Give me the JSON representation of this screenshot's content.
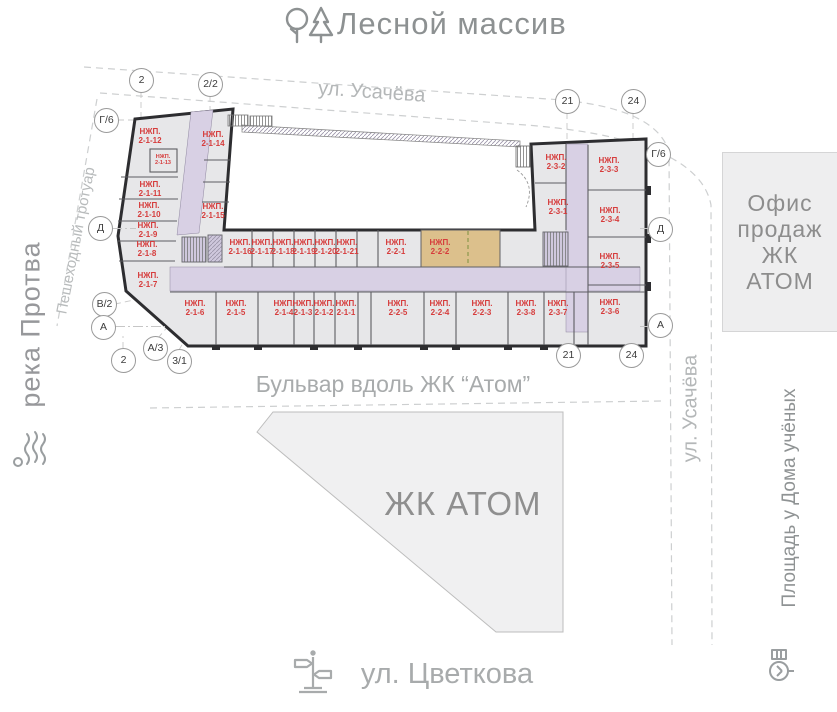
{
  "map": {
    "north_label": "Лесной массив",
    "street_top": "ул. Усачёва",
    "street_right": "ул. Усачёва",
    "street_bottom": "ул. Цветкова",
    "river": "река Протва",
    "sidewalk": "Пешеходный тротуар",
    "boulevard": "Бульвар вдоль ЖК “Атом”",
    "square_right": "Площадь у Дома учёных",
    "complex_area_label": "ЖК АТОМ",
    "sales_office": {
      "lines": [
        "Офис",
        "продаж",
        "ЖК",
        "АТОМ"
      ]
    }
  },
  "building": {
    "unit_prefix": "НЖП.",
    "highlighted_unit": "2-2-2",
    "units": [
      "2-1-12",
      "2-1-13",
      "2-1-14",
      "2-1-11",
      "2-1-10",
      "2-1-9",
      "2-1-8",
      "2-1-7",
      "2-1-15",
      "2-1-16",
      "2-1-17",
      "2-1-18",
      "2-1-19",
      "2-1-20",
      "2-1-21",
      "2-2-1",
      "2-2-2",
      "2-1-6",
      "2-1-5",
      "2-1-4",
      "2-1-3",
      "2-1-2",
      "2-1-1",
      "2-2-5",
      "2-2-4",
      "2-2-3",
      "2-3-8",
      "2-3-7",
      "2-3-2",
      "2-3-3",
      "2-3-1",
      "2-3-4",
      "2-3-5",
      "2-3-6"
    ]
  },
  "axes": [
    {
      "id": "t2",
      "label": "2"
    },
    {
      "id": "t22",
      "label": "2/2"
    },
    {
      "id": "t21",
      "label": "21"
    },
    {
      "id": "t24",
      "label": "24"
    },
    {
      "id": "lg6",
      "label": "Г/6"
    },
    {
      "id": "rg6",
      "label": "Г/6"
    },
    {
      "id": "ld",
      "label": "Д"
    },
    {
      "id": "rd",
      "label": "Д"
    },
    {
      "id": "lb2",
      "label": "В/2"
    },
    {
      "id": "la",
      "label": "А"
    },
    {
      "id": "ra",
      "label": "А"
    },
    {
      "id": "l2",
      "label": "2"
    },
    {
      "id": "la3",
      "label": "А/3"
    },
    {
      "id": "l31",
      "label": "3/1"
    },
    {
      "id": "b21",
      "label": "21"
    },
    {
      "id": "b24",
      "label": "24"
    }
  ],
  "colors": {
    "highlight": "#dcc08c",
    "corridor": "#d8d0e4",
    "wall": "#2d2d30",
    "unit_fill": "#e7e7e9",
    "unit_label_red": "#d63c3c",
    "divider_green": "#7d8f3f",
    "gray_text": "#8d9192"
  }
}
